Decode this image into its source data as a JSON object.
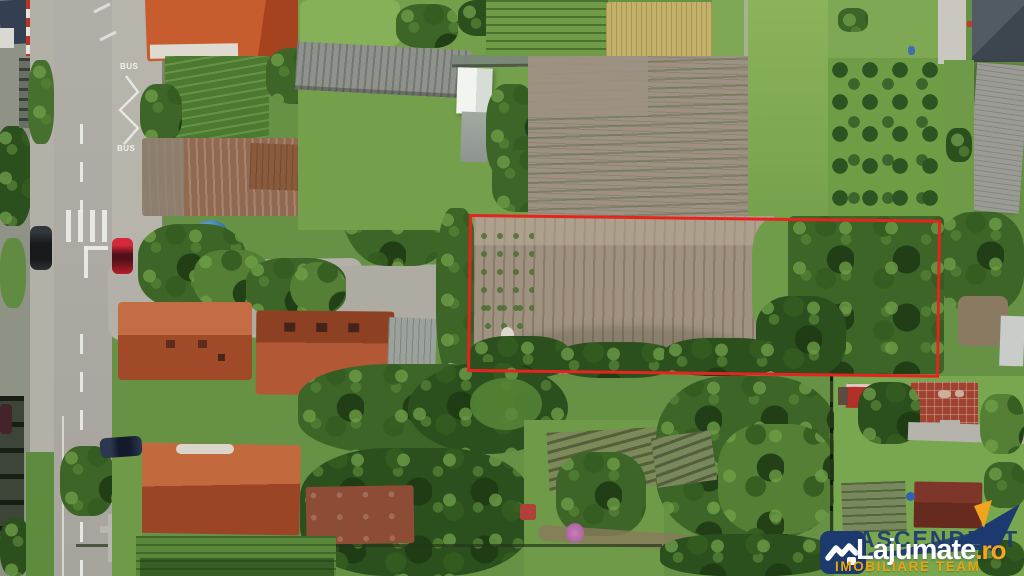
{
  "image": {
    "kind": "aerial-drone-photo",
    "subject": "land plot for sale outlined in red, village street with houses and gardens"
  },
  "road_markings": {
    "bus_top": "BUS",
    "bus_bottom": "BUS"
  },
  "plot_outline": {
    "color": "#e52420"
  },
  "watermark": {
    "agency": "ASCENDENT",
    "brand": "Lajumate",
    "brand_suffix": ".ro",
    "tagline": "IMOBILIARE TEAM",
    "colors": {
      "logo": "#1c3a6e",
      "brand": "#ffffff",
      "suffix": "#f6a41c",
      "tagline": "#e9a410"
    }
  }
}
